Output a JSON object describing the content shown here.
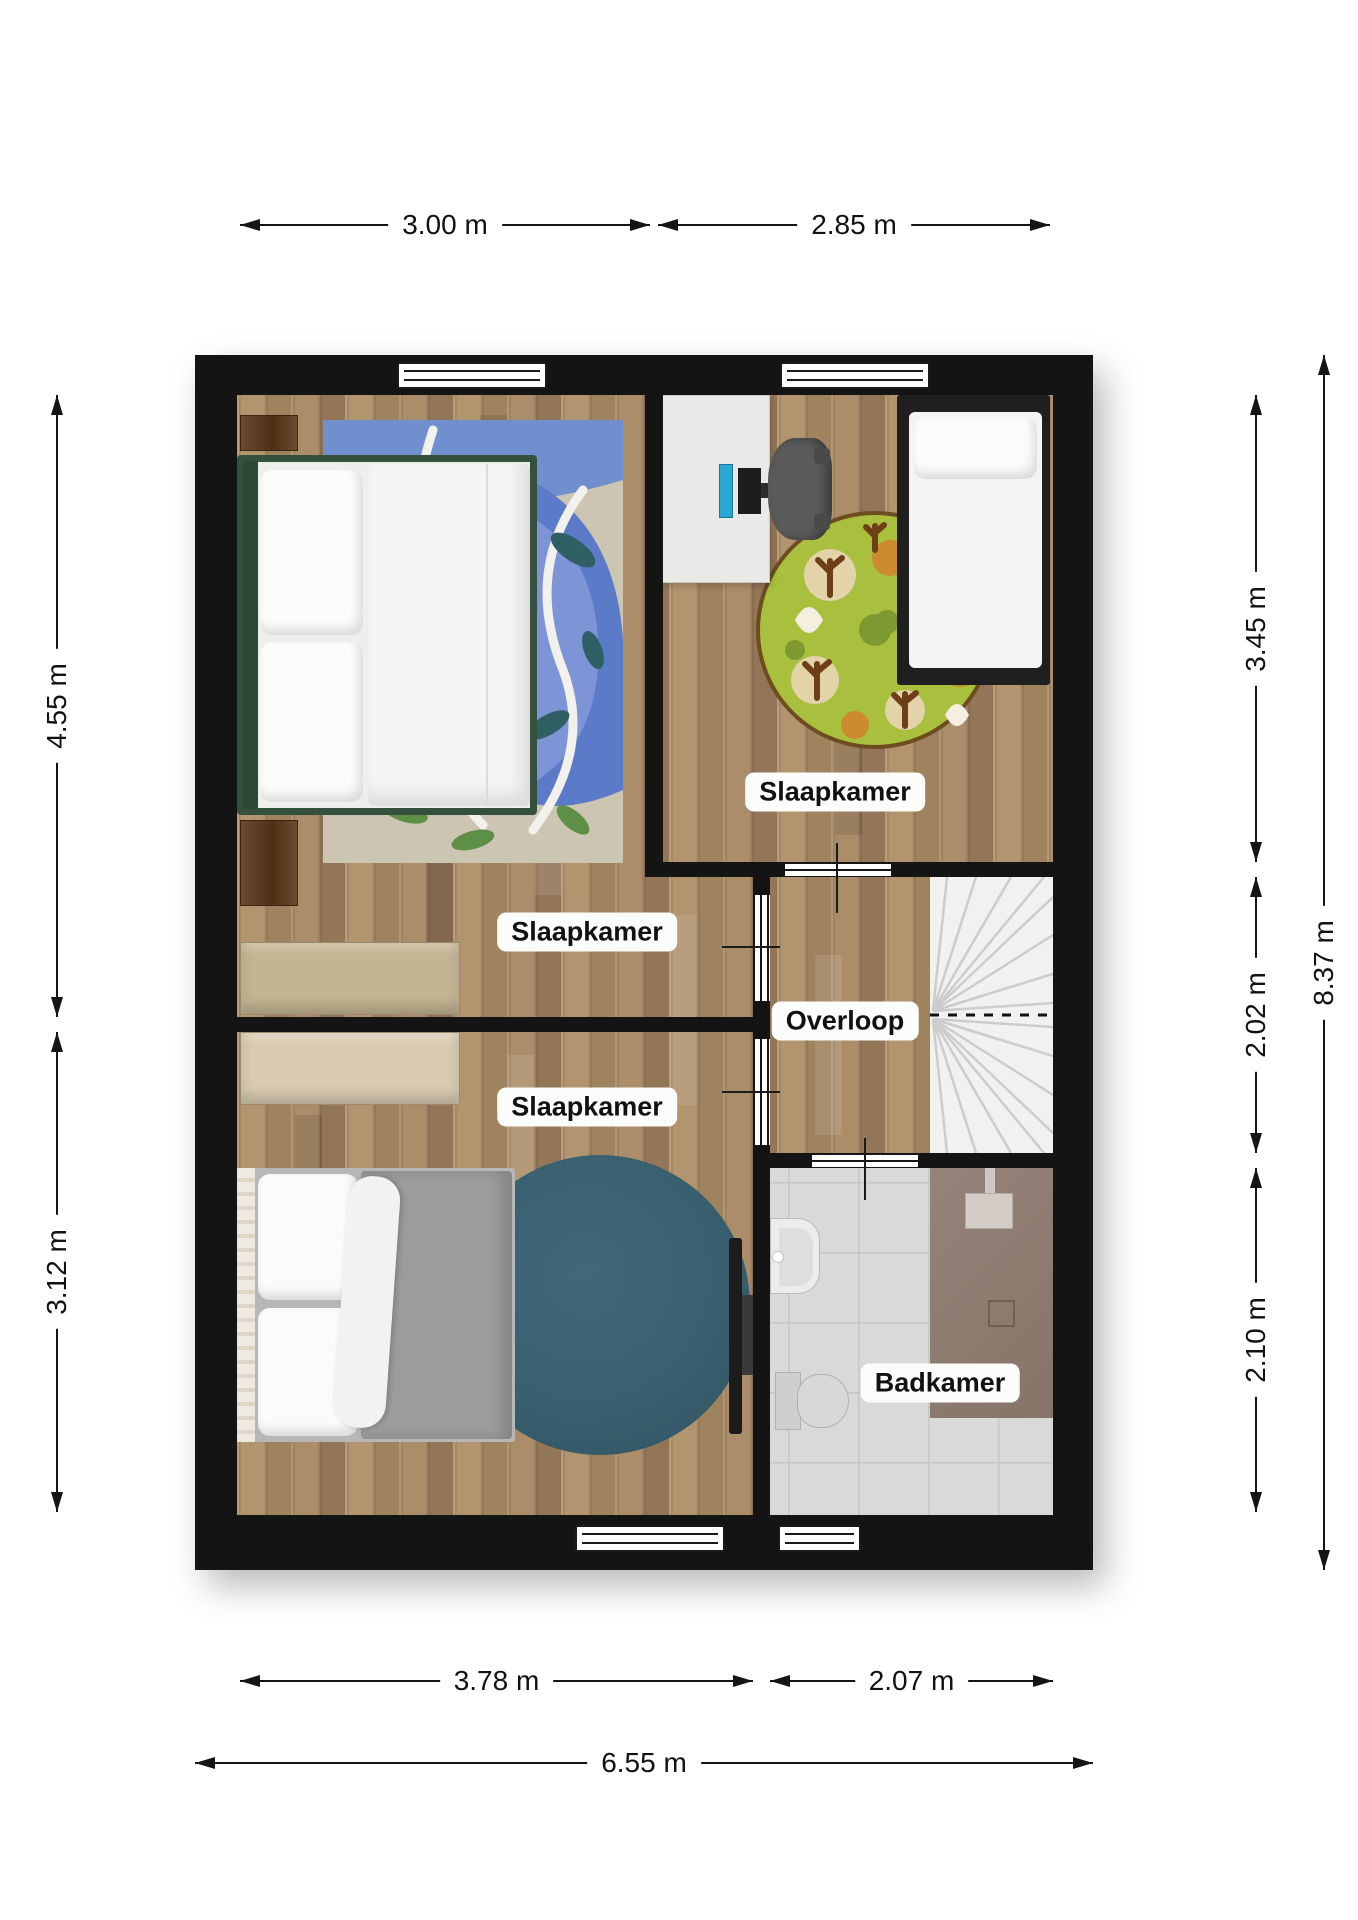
{
  "floorplan": {
    "rooms": [
      {
        "name": "slaapkamer-1",
        "label": "Slaapkamer"
      },
      {
        "name": "slaapkamer-2",
        "label": "Slaapkamer"
      },
      {
        "name": "slaapkamer-3",
        "label": "Slaapkamer"
      },
      {
        "name": "overloop",
        "label": "Overloop"
      },
      {
        "name": "badkamer",
        "label": "Badkamer"
      }
    ],
    "dimensions": {
      "top": [
        {
          "label": "3.00 m"
        },
        {
          "label": "2.85 m"
        }
      ],
      "left": [
        {
          "label": "4.55 m"
        },
        {
          "label": "3.12 m"
        }
      ],
      "right": [
        {
          "label": "3.45 m"
        },
        {
          "label": "2.02 m"
        },
        {
          "label": "2.10 m"
        },
        {
          "label": "8.37 m"
        }
      ],
      "bottom": [
        {
          "label": "3.78 m"
        },
        {
          "label": "2.07 m"
        },
        {
          "label": "6.55 m"
        }
      ]
    },
    "colors": {
      "wall": "#141414",
      "floor_wood": "#a98c68",
      "bathroom_tile": "#d9d9d7",
      "shower": "#8f7e72",
      "stairs": "#f1f1f0",
      "rug_master": "#5b7ac8",
      "rug_kids": "#a9bf3e",
      "rug_round_dark": "#3a5f6f",
      "bed_frame_green": "#35503c",
      "bed_frame_black": "#1f1f1f",
      "label_background": "#fcfcfa",
      "dimension_text": "#111111"
    }
  }
}
